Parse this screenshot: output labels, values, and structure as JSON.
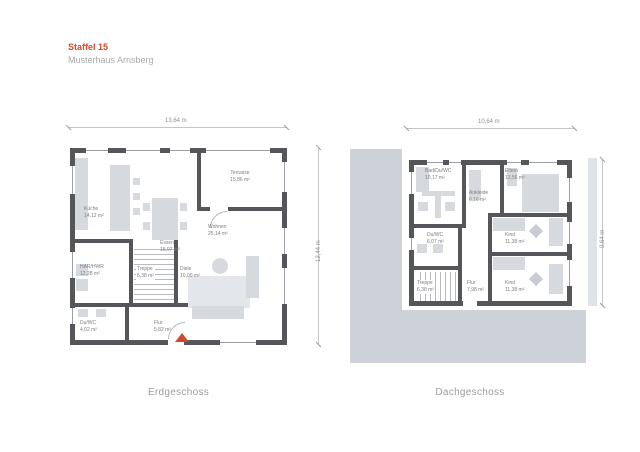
{
  "header": {
    "title": "Staffel 15",
    "subtitle": "Musterhaus Arnsberg"
  },
  "colors": {
    "accent": "#d0492a",
    "wall": "#55565a",
    "furniture": "#d6dade",
    "backdrop": "#ccd2d8",
    "label_text": "#7c7e80"
  },
  "floors": {
    "erdgeschoss": {
      "caption": "Erdgeschoss",
      "width_label": "13,64 m",
      "height_label": "12,44 m",
      "rooms": {
        "kueche": {
          "name": "Küche",
          "area": "14,12 m²"
        },
        "essen": {
          "name": "Essen",
          "area": "15,97 m²"
        },
        "wohnen": {
          "name": "Wohnen",
          "area": "25,14 m²"
        },
        "terrasse": {
          "name": "Terrasse",
          "area": "15,86 m²"
        },
        "hwr": {
          "name": "HAR/HWR",
          "area": "12,28 m²"
        },
        "treppe": {
          "name": "Treppe",
          "area": "6,38 m²"
        },
        "diele": {
          "name": "Diele",
          "area": "10,00 m²"
        },
        "duwc": {
          "name": "Du/WC",
          "area": "4,02 m²"
        },
        "flur": {
          "name": "Flur",
          "area": "5,82 m²"
        }
      }
    },
    "dachgeschoss": {
      "caption": "Dachgeschoss",
      "width_label": "10,64 m",
      "height_label": "9,64 m",
      "rooms": {
        "bad": {
          "name": "Bad/Du/WC",
          "area": "10,17 m²"
        },
        "eltern": {
          "name": "Eltern",
          "area": "13,56 m²"
        },
        "ankleide": {
          "name": "Ankleide",
          "area": "6,16 m²"
        },
        "kind1": {
          "name": "Kind",
          "area": "11,38 m²"
        },
        "duwc": {
          "name": "Du/WC",
          "area": "6,07 m²"
        },
        "treppe": {
          "name": "Treppe",
          "area": "6,38 m²"
        },
        "flur": {
          "name": "Flur",
          "area": "7,98 m²"
        },
        "kind2": {
          "name": "Kind",
          "area": "11,38 m²"
        }
      }
    }
  }
}
